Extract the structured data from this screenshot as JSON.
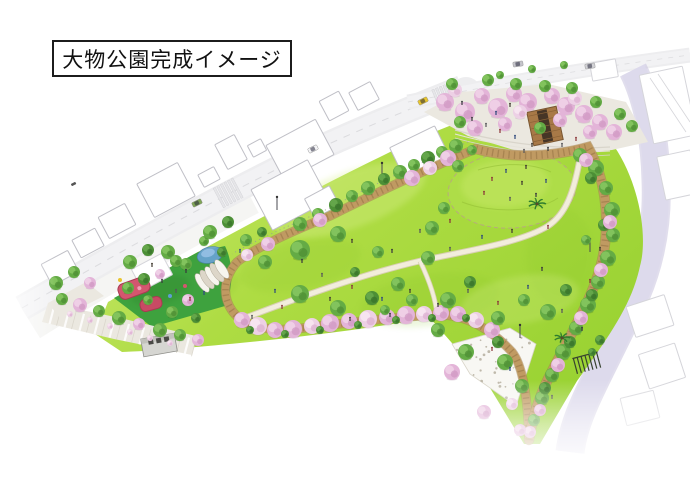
{
  "title": {
    "text": "大物公園完成イメージ"
  },
  "scene_features": [
    "entrance-plaza",
    "central-lawn-mound",
    "playground",
    "pond",
    "canopy-tent",
    "restroom-building",
    "wooden-deck",
    "loop-path",
    "walking-path",
    "cherry-tree-row",
    "stone-plaza",
    "trellis"
  ],
  "palette": {
    "background": "#ffffff",
    "lawn_light": "#cdea75",
    "lawn": "#aedc43",
    "lawn_deep": "#93cf2d",
    "mound": "#aedd48",
    "playground_green": "#3ea23e",
    "tree_green": "#64ab45",
    "tree_green_light": "#85c55f",
    "tree_green_dark": "#4c8f36",
    "cherry_pink": "#e3b4d8",
    "cherry_pink_light": "#edd0e5",
    "path_tan": "#c09a62",
    "path_tie": "#8f6d3f",
    "path_white": "#f2eddc",
    "path_edge": "#d8cfb2",
    "road": "#ededef",
    "road_inner": "#f2f2f4",
    "road_edge": "#d8d8db",
    "road_lavender": "#dcd9ec",
    "road_lavender_edge": "#c4bedb",
    "pavement": "#ebe8e0",
    "plaza_paving": "#f8f7f3",
    "speckle": "#b5ae9e",
    "water": "#6aa2d8",
    "water_light": "#9cc4e8",
    "play_red": "#d4566f",
    "play_red_dark": "#a83a52",
    "deck_brown": "#a87947",
    "deck_dark": "#463526",
    "tent_white": "#f7f5ef",
    "tent_shade": "#ddd6c9",
    "building_fill": "#ffffff",
    "building_stroke": "#bfbfc6",
    "building_stroke_faint": "#d5d5da",
    "restroom_gray": "#d6d6d2",
    "figure_dark": "#38383c",
    "car_yellow": "#e7c52e",
    "car_white": "#f4f4f6",
    "car_green": "#7fa456"
  }
}
